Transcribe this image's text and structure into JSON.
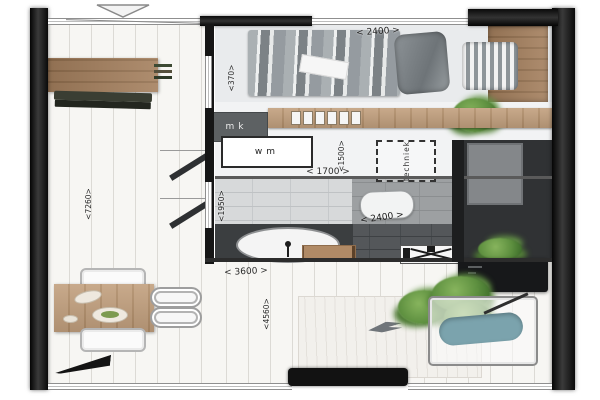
{
  "plan": {
    "dimensions": {
      "bedroom_width": "< 2400 >",
      "bedroom_side": "<370>",
      "hall_width": "< 1700 >",
      "hall_depth": "<1500>",
      "bath_width": "< 2400 >",
      "bath_depth": "<1950>",
      "living_width": "< 3600 >",
      "living_depth": "<4560>",
      "living_height_total": "<7260>"
    },
    "rooms": {
      "mk_label": "mk",
      "wm_label": "wm",
      "techniek_label": "techniek"
    },
    "colors": {
      "wall": "#1b1b1b",
      "wood": "#c2a07e",
      "wood_dark": "#9c7a5c",
      "teal_cushion": "#7ba3ad",
      "plant_green": "#5d8f3f",
      "tile_light": "#d7d9da",
      "floor_dark": "#54575a"
    }
  }
}
